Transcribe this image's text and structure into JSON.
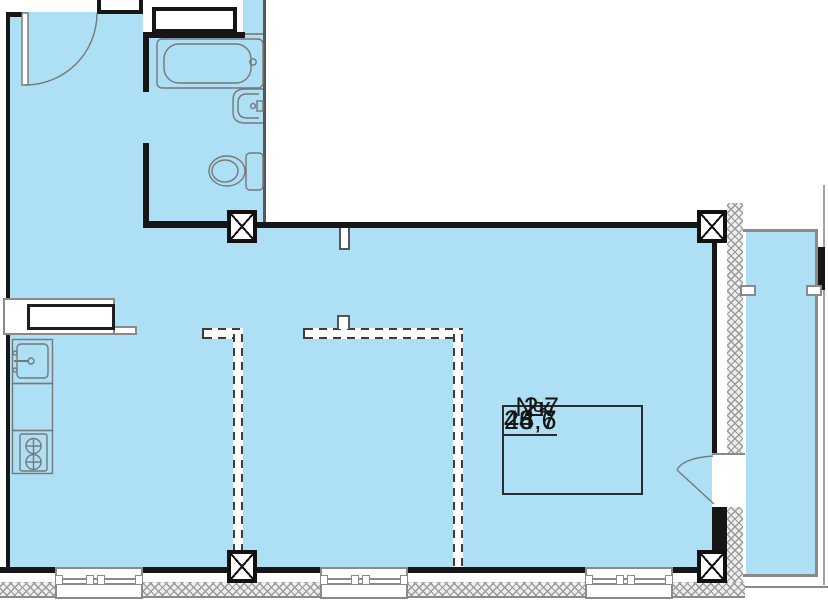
{
  "unit_info": {
    "number": "№7",
    "rooms": "2к",
    "areas": [
      "24,6",
      "46,7",
      "48,7"
    ]
  },
  "colors": {
    "room_fill": "#aee0f5",
    "wall": "#161616",
    "fixture_line": "#777777",
    "hatch_line": "#8a8a8a"
  }
}
